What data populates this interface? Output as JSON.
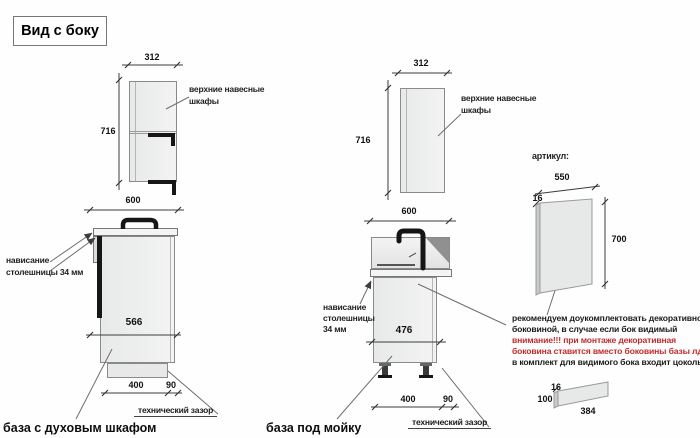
{
  "title": "Вид с боку",
  "colors": {
    "warning_red": "#c02b2b",
    "drawing_line": "#3c3c3c"
  },
  "wall_cabinets": {
    "width": "312",
    "height": "716",
    "label_line1": "верхние навесные",
    "label_line2": "шкафы"
  },
  "oven_base": {
    "top_width": "600",
    "body_depth": "566",
    "plinth_depth": "400",
    "gap": "90",
    "gap_label": "технический зазор",
    "overhang_line1": "нависание",
    "overhang_line2": "столешницы 34 мм",
    "caption": "база с духовым шкафом"
  },
  "sink_base": {
    "top_width": "600",
    "body_depth": "476",
    "plinth_depth": "400",
    "gap": "90",
    "gap_label": "технический зазор",
    "overhang_line1": "нависание",
    "overhang_line2": "столешницы",
    "overhang_line3": "34 мм",
    "caption": "база под мойку"
  },
  "side_panel": {
    "heading": "артикул:",
    "width": "550",
    "thickness": "16",
    "height": "700"
  },
  "note": {
    "line1": "рекомендуем доукомплектовать декоративной",
    "line2": "боковиной, в случае если бок видимый",
    "line3": "внимание!!! при монтаже декоративная",
    "line4": "боковина ставится вместо боковины базы лдсп",
    "line5": "в комплект для видимого бока входит цоколь:"
  },
  "plinth_panel": {
    "thickness": "16",
    "height": "100",
    "length": "384"
  }
}
